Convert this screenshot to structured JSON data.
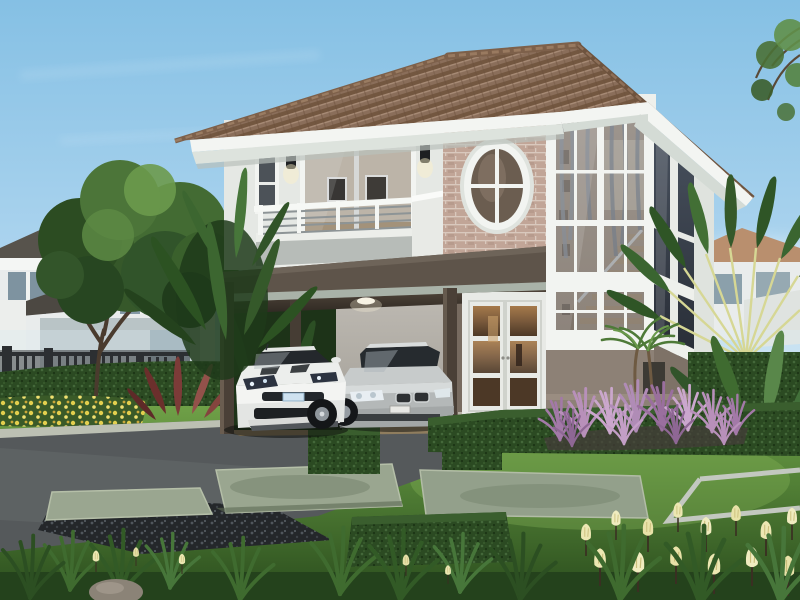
{
  "scene": {
    "type": "architectural-exterior-render",
    "description": "Daytime 3D rendering of a modern two-story suburban house with a terracotta hip roof, brick accent wall with oval window, two-story corner window tower, upper balcony, and an open carport sheltering a white sports car and a silver sedan. Manicured front lawn with stepping stones, trimmed hedges, purple fountain grass, yellow flowers, palms and a large garden tree under a light blue sky.",
    "objects": [
      {
        "name": "main-house",
        "label": "two-story house with hip roof"
      },
      {
        "name": "roof",
        "label": "brown terracotta tile hip roof with white fascia"
      },
      {
        "name": "balcony",
        "label": "second-floor balcony with metal railing and sliding glass door"
      },
      {
        "name": "oval-window",
        "label": "oval window with cross muntins on brick accent wall"
      },
      {
        "name": "window-tower",
        "label": "two-story corner window bay showing interior staircase"
      },
      {
        "name": "entry-door",
        "label": "white French entry doors with warm interior light"
      },
      {
        "name": "carport",
        "label": "open carport with dark posts and ceiling light"
      },
      {
        "name": "white-sports-car",
        "label": "white sports coupe parked in carport"
      },
      {
        "name": "silver-sedan",
        "label": "silver sedan parked in carport"
      },
      {
        "name": "garden-tree",
        "label": "large green garden tree"
      },
      {
        "name": "travelers-palm",
        "label": "fan-shaped travelers palm"
      },
      {
        "name": "purple-fountain-grass",
        "label": "bed of purple fountain grass"
      },
      {
        "name": "tulip-flowers",
        "label": "pale yellow tulips in foreground"
      },
      {
        "name": "marigold-bed",
        "label": "yellow marigold flower bed"
      },
      {
        "name": "stepping-stones",
        "label": "concrete stepping stone pavers in lawn"
      },
      {
        "name": "driveway",
        "label": "dark paved driveway"
      },
      {
        "name": "perimeter-fence",
        "label": "dark vertical-slat fence"
      },
      {
        "name": "background-houses",
        "label": "neighboring houses behind trees"
      }
    ]
  },
  "colors": {
    "sky_top": "#8cc4e6",
    "sky_mid": "#bcdcf2",
    "sky_horizon": "#eaf4fb",
    "roof_tile": "#8a6e5a",
    "roof_tile_dark": "#6f543f",
    "roof_ridge": "#7d604a",
    "fascia_white": "#f3f5f2",
    "soffit": "#dde3dd",
    "wall_white": "#eef0ec",
    "wall_shadow": "#d4d7d2",
    "brick": "#c9ae9f",
    "brick_mortar": "#e4d5ca",
    "slab_dark": "#5e544a",
    "slab_strip": "#a9b2a8",
    "post_brown": "#4a4037",
    "garage_wall": "#b5b1aa",
    "taupe_wall": "#8d8176",
    "taupe_dark": "#776b60",
    "glass_dark": "#3c4450",
    "curtain": "#9aa2ab",
    "stair_wall": "#c8b5a0",
    "stair_wood": "#cdb393",
    "door_glass_warm": "#7a5a3c",
    "balcony_gray": "#b7bcb8",
    "rail_metal": "#8d9496",
    "lawn_light": "#74a44b",
    "lawn_mid": "#4f7d31",
    "lawn_dark": "#2d4f1f",
    "hedge": "#2b4a22",
    "hedge_light": "#44683a",
    "driveway": "#55595b",
    "curb": "#bcc0b3",
    "paver": "#9aa690",
    "gravel": "#24272a",
    "carport_floor": "#8f7d5e",
    "purple_grass": "#b08cb6",
    "purple_light": "#cfaad2",
    "purple_dark": "#8e6794",
    "marigold": "#e3cf4e",
    "tulip": "#ece7b2",
    "cordyline": "#7c3b38",
    "tree_green": "#436b33",
    "tree_dark": "#2c4c22",
    "tree_light": "#6b9a4c",
    "banana": "#3c6630",
    "banana_dark": "#24421d",
    "palm_stem": "#d6d794",
    "fence": "#2c2f32",
    "bg_roof_left": "#57534c",
    "bg_roof_right": "#b98f6e",
    "bg_wall": "#e9ecec",
    "car_white": "#eceeec",
    "car_silver": "#c7cbcb",
    "car_glass": "#262b2f",
    "tire": "#15171a",
    "rim": "#959ca2",
    "rock": "#8b8377"
  }
}
